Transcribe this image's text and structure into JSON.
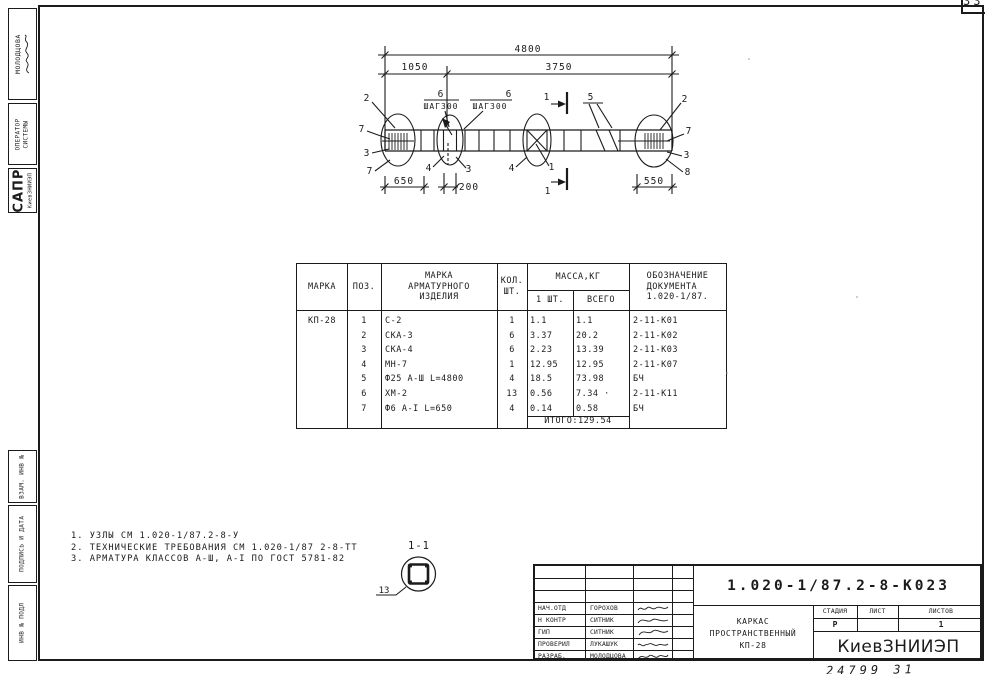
{
  "meta": {
    "corner_sheet_number": "33",
    "handwritten_number": "24799  31"
  },
  "colors": {
    "ink": "#1b1b1b",
    "paper": "#ffffff"
  },
  "left_sidebar": {
    "molodtsova": "МОЛОДЦОВА",
    "operator1": "ОПЕРАТОР",
    "operator2": "СИСТЕМЫ",
    "sapr": "САПР",
    "sapr_sub": "КиевЗНИИЭП",
    "vzam": "ВЗАМ. ИНВ №",
    "podpis": "ПОДПИСЬ И ДАТА",
    "inv": "ИНВ № ПОДЛ"
  },
  "drawing": {
    "dims": {
      "total": "4800",
      "left": "1050",
      "right": "3750",
      "d650": "650",
      "d200": "200",
      "d550": "550"
    },
    "step_note": {
      "num": "6",
      "text": "ШАГ300"
    },
    "section_label": "1",
    "callouts": {
      "left": [
        "2",
        "7",
        "3",
        "7"
      ],
      "mid": [
        "4",
        "3",
        "4",
        "1"
      ],
      "top5": "5",
      "right": [
        "2",
        "7",
        "3",
        "8"
      ]
    }
  },
  "table": {
    "headers": {
      "marka": "МАРКА",
      "poz": "ПОЗ.",
      "izd1": "МАРКА",
      "izd2": "АРМАТУРНОГО",
      "izd3": "ИЗДЕЛИЯ",
      "kol1": "КОЛ.",
      "kol2": "ШТ.",
      "massa": "МАССА,КГ",
      "m1": "1 ШТ.",
      "mv": "ВСЕГО",
      "doc1": "ОБОЗНАЧЕНИЕ",
      "doc2": "ДОКУМЕНТА",
      "doc3": "1.020-1/87."
    },
    "marka_value": "КП-28",
    "rows": [
      {
        "poz": "1",
        "izd": "С-2",
        "kol": "1",
        "m1": "1.1",
        "mv": "1.1",
        "doc": "2-11-К01"
      },
      {
        "poz": "2",
        "izd": "СКА-3",
        "kol": "6",
        "m1": "3.37",
        "mv": "20.2",
        "doc": "2-11-К02"
      },
      {
        "poz": "3",
        "izd": "СКА-4",
        "kol": "6",
        "m1": "2.23",
        "mv": "13.39",
        "doc": "2-11-К03"
      },
      {
        "poz": "4",
        "izd": "МН-7",
        "kol": "1",
        "m1": "12.95",
        "mv": "12.95",
        "doc": "2-11-К07"
      },
      {
        "poz": "5",
        "izd": "Ф25 А-Ш L=4800",
        "kol": "4",
        "m1": "18.5",
        "mv": "73.98",
        "doc": "БЧ"
      },
      {
        "poz": "6",
        "izd": "ХМ-2",
        "kol": "13",
        "m1": "0.56",
        "mv": "7.34 ·",
        "doc": "2-11-К11"
      },
      {
        "poz": "7",
        "izd": "Ф6 А-I L=650",
        "kol": "4",
        "m1": "0.14",
        "mv": "0.58",
        "doc": "БЧ"
      }
    ],
    "total": "ИТОГО:129.54"
  },
  "notes": {
    "items": [
      "1. УЗЛЫ СМ 1.020-1/87.2-8-У",
      "2. ТЕХНИЧЕСКИЕ ТРЕБОВАНИЯ СМ 1.020-1/87 2-8-ТТ",
      "3. АРМАТУРА КЛАССОВ А-Ш, А-I ПО ГОСТ 5781-82"
    ]
  },
  "section_detail": {
    "title": "1-1",
    "bar_mark": "13"
  },
  "title_block": {
    "doc_number": "1.020-1/87.2-8-К023",
    "title1": "КАРКАС",
    "title2": "ПРОСТРАНСТВЕННЫЙ",
    "title3": "КП-28",
    "h_stage": "СТАДИЯ",
    "h_list": "ЛИСТ",
    "h_listov": "ЛИСТОВ",
    "stage": "Р",
    "listov": "1",
    "org": "КиевЗНИИЭП",
    "rows": [
      {
        "role": "НАЧ.ОТД",
        "name": "ГОРОХОВ"
      },
      {
        "role": "Н КОНТР",
        "name": "СИТНИК"
      },
      {
        "role": "ГИП",
        "name": "СИТНИК"
      },
      {
        "role": "ПРОВЕРИЛ",
        "name": "ЛУКАШУК"
      },
      {
        "role": "РАЗРАБ.",
        "name": "МОЛОДЦОВА"
      }
    ]
  }
}
